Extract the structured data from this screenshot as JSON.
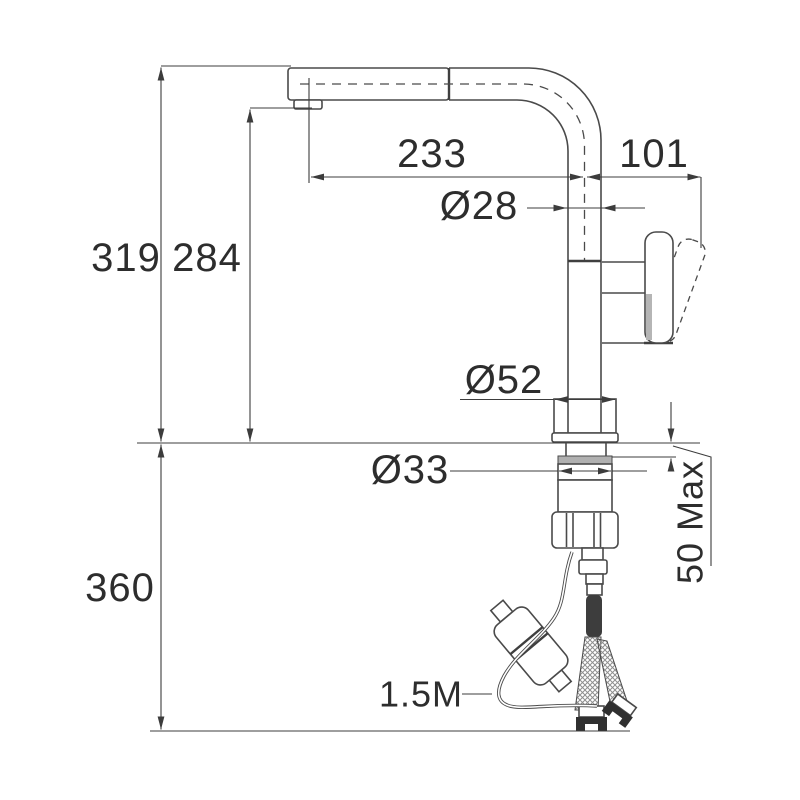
{
  "figure": {
    "colors": {
      "line": "#4a4a4a",
      "text": "#2d2d2d",
      "background": "#ffffff",
      "shade_fill": "#b5b5b5",
      "dark_fill": "#383838"
    }
  },
  "dims": {
    "overall_height": "319",
    "spout_height": "284",
    "spout_reach": "233",
    "handle_reach": "101",
    "spout_tube_diameter": "Ø28",
    "base_diameter": "Ø52",
    "mounting_hole_diameter": "Ø33",
    "max_counter_thickness": "50 Max",
    "under_counter_clearance": "360",
    "hose_length": "1.5M"
  }
}
